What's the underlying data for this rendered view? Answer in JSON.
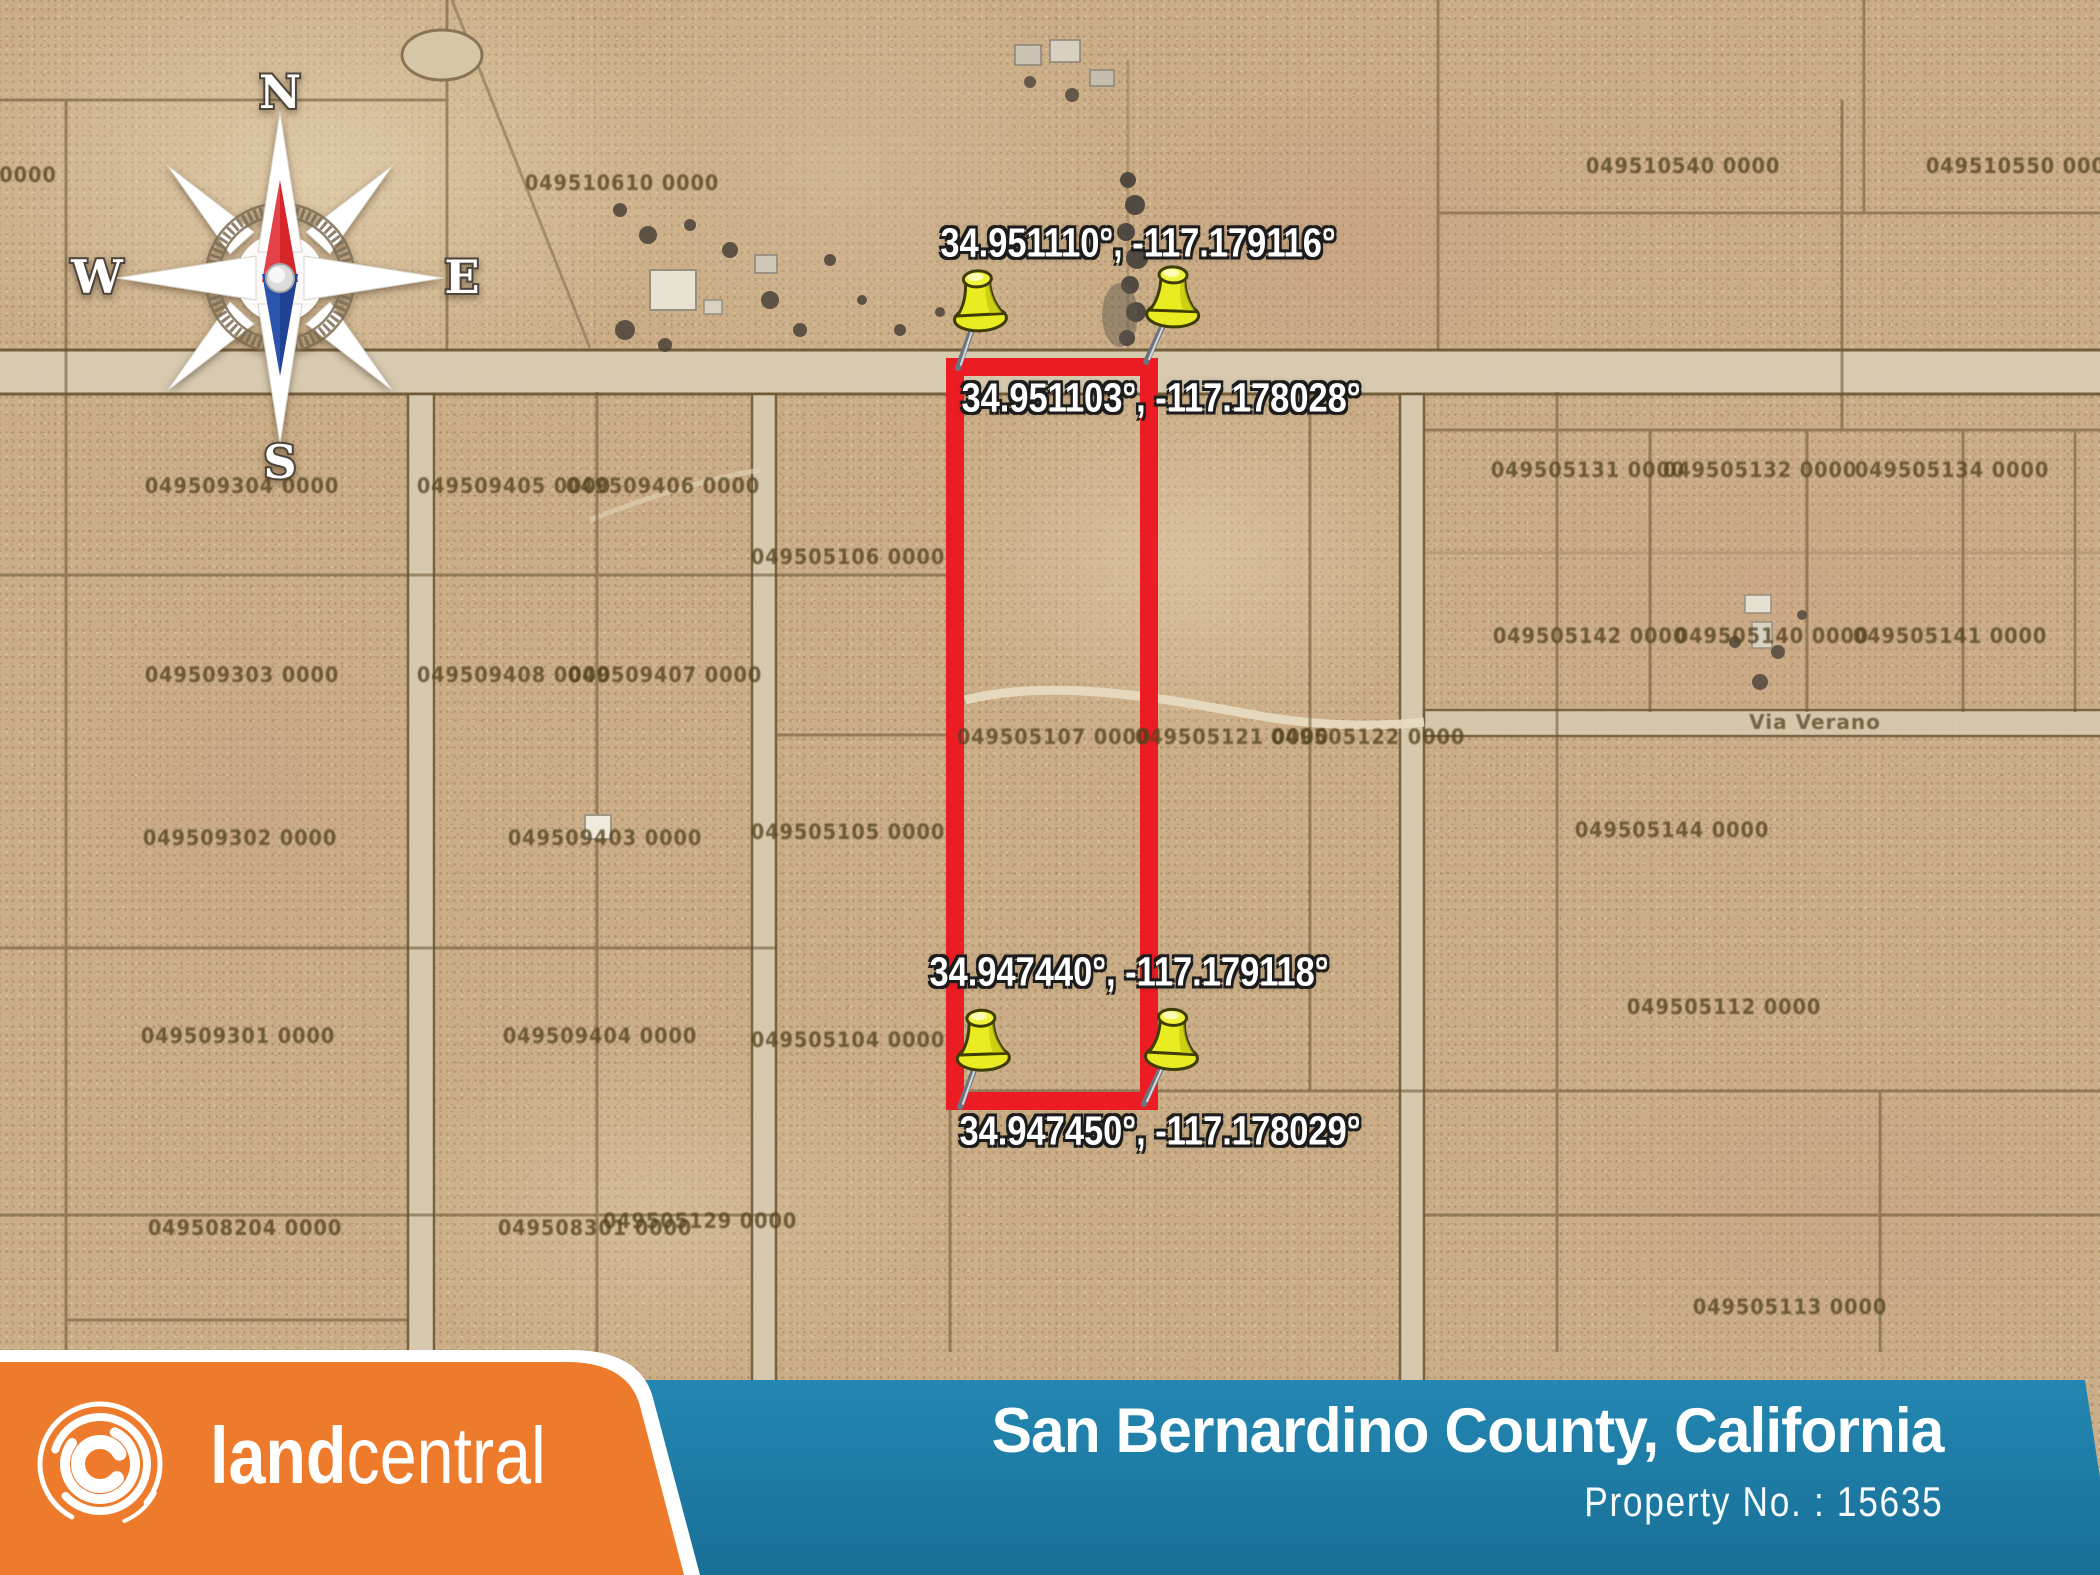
{
  "theme": {
    "orange": "#ee7a2b",
    "blue_top": "#2387b2",
    "blue_bottom": "#196f96",
    "outline_red": "#ec1c24",
    "map_base": "#cbae87",
    "road": "#d9ccb2",
    "pin_yellow": "#e9ec20"
  },
  "map": {
    "compass": {
      "n": "N",
      "e": "E",
      "s": "S",
      "w": "W"
    },
    "road_label": "Via Verano",
    "coordinate_labels": [
      {
        "text": "34.951110°, -117.179116°",
        "x": 1138,
        "y": 243
      },
      {
        "text": "34.951103°, -117.178028°",
        "x": 1161,
        "y": 398
      },
      {
        "text": "34.947440°, -117.179118°",
        "x": 1129,
        "y": 972
      },
      {
        "text": "34.947450°, -117.178029°",
        "x": 1160,
        "y": 1131
      }
    ],
    "pins": [
      {
        "x": 958,
        "y": 368,
        "r": -3
      },
      {
        "x": 1146,
        "y": 362,
        "r": 2
      },
      {
        "x": 960,
        "y": 1107,
        "r": -2
      },
      {
        "x": 1144,
        "y": 1104,
        "r": 3
      }
    ],
    "parcel_labels": [
      {
        "text": "0000",
        "x": 28,
        "y": 175
      },
      {
        "text": "049510610 0000",
        "x": 622,
        "y": 183
      },
      {
        "text": "049510540 0000",
        "x": 1683,
        "y": 166
      },
      {
        "text": "049510550 0000",
        "x": 2023,
        "y": 166
      },
      {
        "text": "049505131 0000",
        "x": 1588,
        "y": 470
      },
      {
        "text": "049505132 0000",
        "x": 1760,
        "y": 470
      },
      {
        "text": "049505134 0000",
        "x": 1952,
        "y": 470
      },
      {
        "text": "049509304 0000",
        "x": 242,
        "y": 486
      },
      {
        "text": "049509405 0000",
        "x": 514,
        "y": 486
      },
      {
        "text": "049509406 0000",
        "x": 663,
        "y": 486
      },
      {
        "text": "049505106 0000",
        "x": 848,
        "y": 557
      },
      {
        "text": "049505142 0000",
        "x": 1590,
        "y": 636
      },
      {
        "text": "049505140 0000",
        "x": 1772,
        "y": 636
      },
      {
        "text": "049505141 0000",
        "x": 1950,
        "y": 636
      },
      {
        "text": "049509303 0000",
        "x": 242,
        "y": 675
      },
      {
        "text": "049509408 0000",
        "x": 514,
        "y": 675
      },
      {
        "text": "049509407 0000",
        "x": 665,
        "y": 675
      },
      {
        "text": "049505107 0000",
        "x": 1054,
        "y": 737
      },
      {
        "text": "049505121 0000",
        "x": 1232,
        "y": 737
      },
      {
        "text": "049505122 0000",
        "x": 1368,
        "y": 737
      },
      {
        "text": "049509302 0000",
        "x": 240,
        "y": 838
      },
      {
        "text": "049509403 0000",
        "x": 605,
        "y": 838
      },
      {
        "text": "049505105 0000",
        "x": 848,
        "y": 832
      },
      {
        "text": "049505144 0000",
        "x": 1672,
        "y": 830
      },
      {
        "text": "049505112 0000",
        "x": 1724,
        "y": 1007
      },
      {
        "text": "049509301 0000",
        "x": 238,
        "y": 1036
      },
      {
        "text": "049509404 0000",
        "x": 600,
        "y": 1036
      },
      {
        "text": "049505104 0000",
        "x": 848,
        "y": 1040
      },
      {
        "text": "049508204 0000",
        "x": 245,
        "y": 1228
      },
      {
        "text": "049508301 0000",
        "x": 595,
        "y": 1228
      },
      {
        "text": "049505129 0000",
        "x": 700,
        "y": 1221
      },
      {
        "text": "049505113 0000",
        "x": 1790,
        "y": 1307
      }
    ]
  },
  "footer": {
    "brand": {
      "land": "land",
      "central": "central"
    },
    "county_title": "San Bernardino County, California",
    "property_no_label": "Property No. : 15635"
  }
}
